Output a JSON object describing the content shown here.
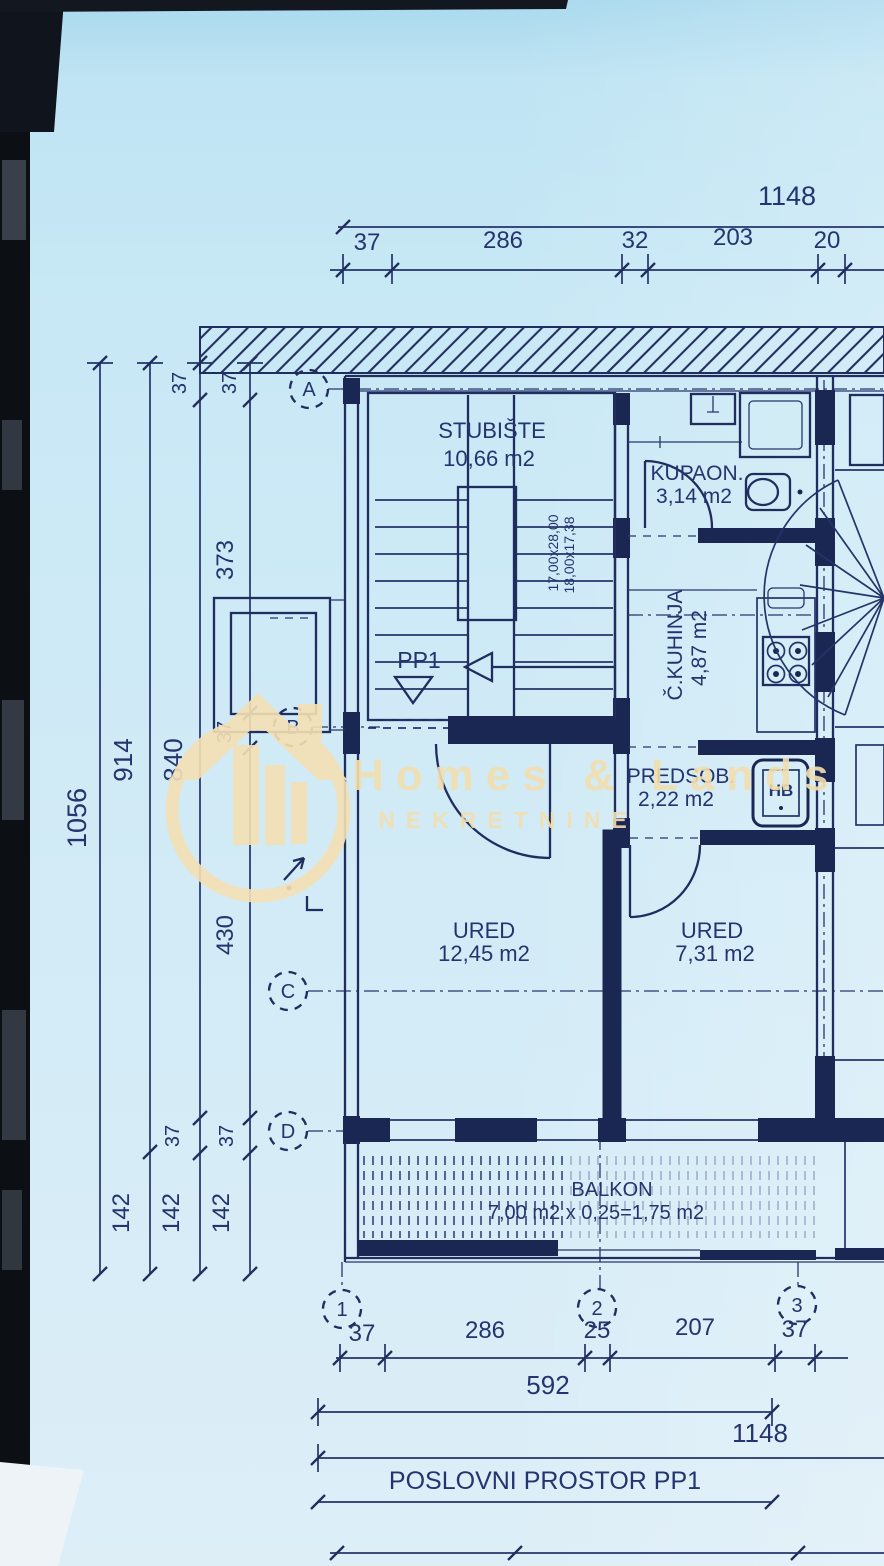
{
  "watermark": {
    "brand": "Homes & Lands",
    "tagline": "NEKRETNINE"
  },
  "plan": {
    "unit_label": "PP1",
    "footer": "POSLOVNI PROSTOR PP1",
    "boiler_label": "HB",
    "rooms": {
      "stairwell": {
        "name": "STUBIŠTE",
        "area": "10,66 m2"
      },
      "bathroom": {
        "name": "KUPAON.",
        "area": "3,14 m2"
      },
      "kitchen": {
        "name": "Č.KUHINJA",
        "area": "4,87 m2"
      },
      "hall": {
        "name": "PREDSOB.",
        "area": "2,22 m2"
      },
      "office1": {
        "name": "URED",
        "area": "12,45 m2"
      },
      "office2": {
        "name": "URED",
        "area": "7,31 m2"
      },
      "balcony": {
        "name": "BALKON",
        "area": "7,00 m2 x 0,25=1,75 m2"
      }
    },
    "stair_notes": [
      "17,00x28,00",
      "18,00x17,38"
    ],
    "grid": {
      "rows": [
        "A",
        "B",
        "C",
        "D"
      ],
      "cols": [
        "1",
        "2",
        "3"
      ]
    }
  },
  "dimensions": {
    "top": {
      "total": "1148",
      "segments": [
        "37",
        "286",
        "32",
        "203",
        "20"
      ]
    },
    "left": {
      "total": "1056",
      "v914": "914",
      "v840": "840",
      "v373": "373",
      "v430": "430",
      "v37": "37",
      "v142": "142"
    },
    "bottom": {
      "segments": [
        "37",
        "286",
        "25",
        "207",
        "37"
      ],
      "row_592": "592",
      "row_1148": "1148"
    }
  },
  "colors": {
    "paper": "#cfeaf6",
    "ink": "#24346e",
    "watermark": "#f4e1b5",
    "photo_edge": "#0c0f14"
  }
}
